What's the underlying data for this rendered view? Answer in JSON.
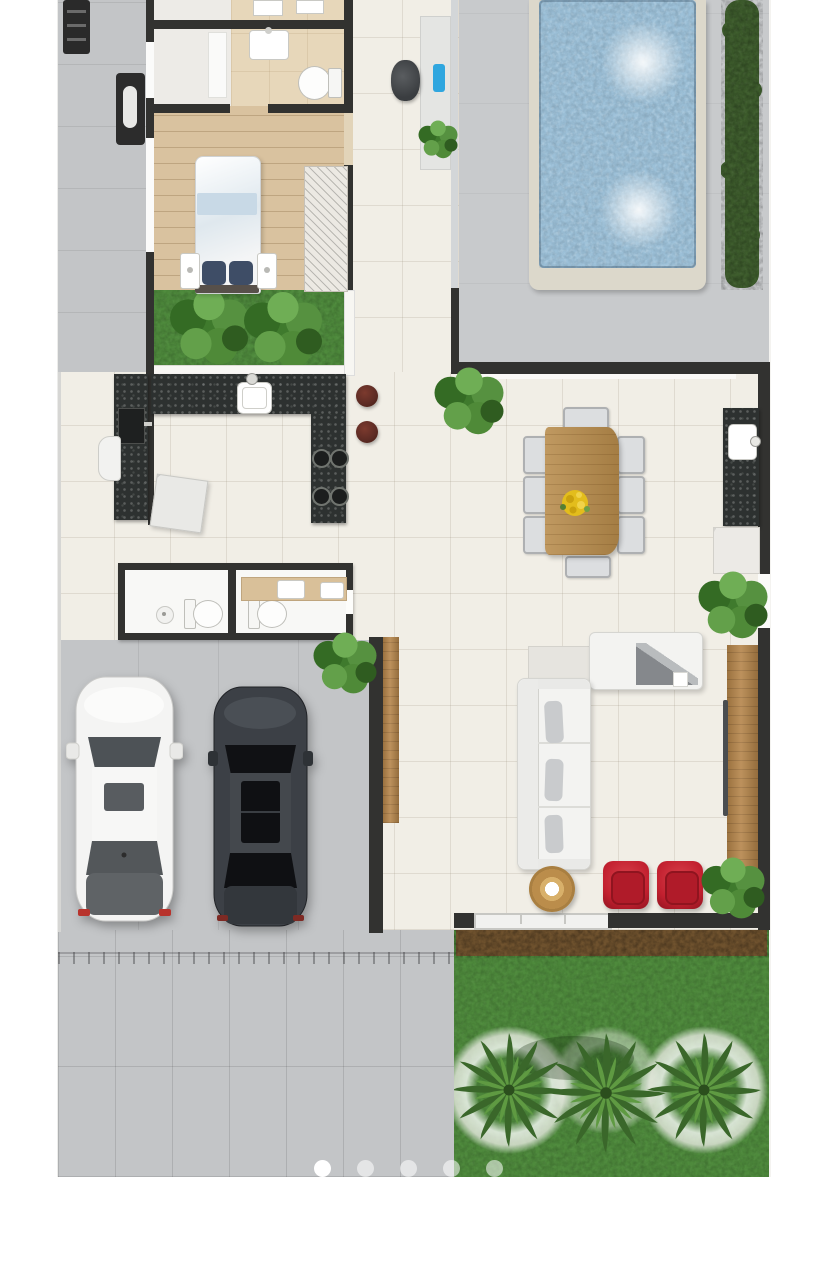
{
  "scene": {
    "description_type": "house-floor-plan-render",
    "carousel": {
      "dot_count": 5,
      "active_dot": 1
    },
    "counts": {
      "pools": 1,
      "cars": 2,
      "palm_trees": 3,
      "dining_chairs": 8,
      "red_armchairs": 2,
      "bar_stools": 2,
      "toilets": 3,
      "garden_bushes": 2
    }
  },
  "colors": {
    "page_bg": "#ffffff",
    "plan_bg": "#f4f3f0",
    "wall": "#323230",
    "concrete": "#c3c5c7",
    "deck": "#c8cacc",
    "interior_floor": "#f1eee6",
    "wood_floor": "#d9c29f",
    "bath_floor": "#e7d7ba",
    "water": "#9cc0d8",
    "coping": "#dcd8cb",
    "lawn": "#4e8a3c",
    "hedge": "#3d5c2c",
    "mulch": "#6f522e",
    "granite": "#2d3130",
    "wood": "#b5854a",
    "table_wood": "#b78b4b",
    "sofa": "#f3f3f1",
    "chair_red": "#c2202f",
    "stool": "#5c2b24",
    "accent_blue": "#2fa6df",
    "car_white": "#f4f4f3",
    "car_dark": "#3c4046",
    "glass": "#d3d6d8",
    "dot_active": "#ffffff",
    "dot_inactive": "rgba(255,255,255,0.55)"
  }
}
